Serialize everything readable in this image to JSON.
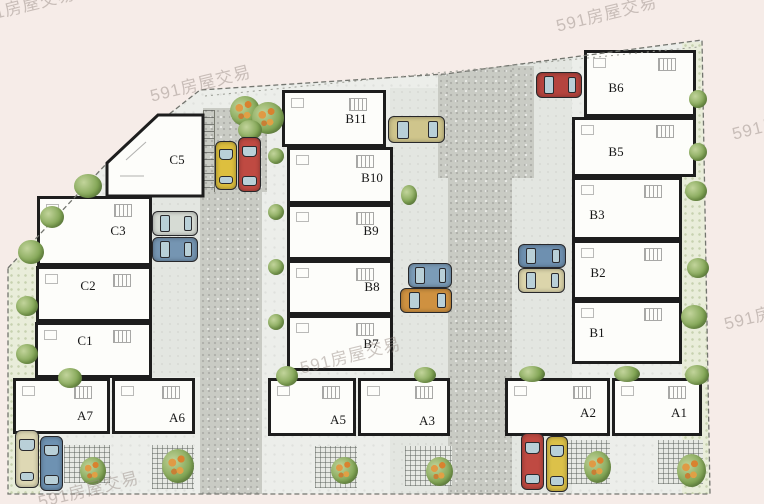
{
  "watermark": {
    "text": "591房屋交易"
  },
  "plan": {
    "units": [
      {
        "label": "C5"
      },
      {
        "label": "C3"
      },
      {
        "label": "C2"
      },
      {
        "label": "C1"
      },
      {
        "label": "B11"
      },
      {
        "label": "B10"
      },
      {
        "label": "B9"
      },
      {
        "label": "B8"
      },
      {
        "label": "B7"
      },
      {
        "label": "B6"
      },
      {
        "label": "B5"
      },
      {
        "label": "B3"
      },
      {
        "label": "B2"
      },
      {
        "label": "B1"
      },
      {
        "label": "A7"
      },
      {
        "label": "A6"
      },
      {
        "label": "A5"
      },
      {
        "label": "A3"
      },
      {
        "label": "A2"
      },
      {
        "label": "A1"
      }
    ],
    "cars": [
      {
        "name": "yellow-car-left-pad",
        "color": "#ddbf3e",
        "orientation": "vertical"
      },
      {
        "name": "red-car-left-pad",
        "color": "#bf4a42",
        "orientation": "vertical"
      },
      {
        "name": "silver-car-near-c3",
        "color": "#d6dbd4",
        "orientation": "horizontal"
      },
      {
        "name": "blue-car-near-c3",
        "color": "#7595b2",
        "orientation": "horizontal"
      },
      {
        "name": "cream-car-near-a7",
        "color": "#ded8b4",
        "orientation": "vertical"
      },
      {
        "name": "blue-car-near-a7",
        "color": "#6e92b2",
        "orientation": "vertical"
      },
      {
        "name": "tan-car-near-b11",
        "color": "#cfc58c",
        "orientation": "horizontal"
      },
      {
        "name": "red-car-top-right",
        "color": "#b5443e",
        "orientation": "horizontal"
      },
      {
        "name": "blue-car-near-b8",
        "color": "#7b9cb8",
        "orientation": "horizontal"
      },
      {
        "name": "orange-car-near-b8",
        "color": "#cf9140",
        "orientation": "horizontal"
      },
      {
        "name": "blue-car-near-b2",
        "color": "#6e90b0",
        "orientation": "horizontal"
      },
      {
        "name": "cream-car-near-b2",
        "color": "#dcd5ab",
        "orientation": "horizontal"
      },
      {
        "name": "red-car-near-a2",
        "color": "#bf4a42",
        "orientation": "vertical"
      },
      {
        "name": "yellow-car-near-a2",
        "color": "#dcc149",
        "orientation": "vertical"
      }
    ],
    "colors": {
      "background_pink": "#f6ece8",
      "site_concrete": "#eceeea",
      "road_gray": "#c9cbc4",
      "apron_gray": "#e3e6e1",
      "garden_green": "#e9edda",
      "building_fill": "#fdfdfa",
      "wall_black": "#1d1d1d",
      "bush_green": "#7fa352",
      "flower_orange": "#d9822f"
    }
  }
}
